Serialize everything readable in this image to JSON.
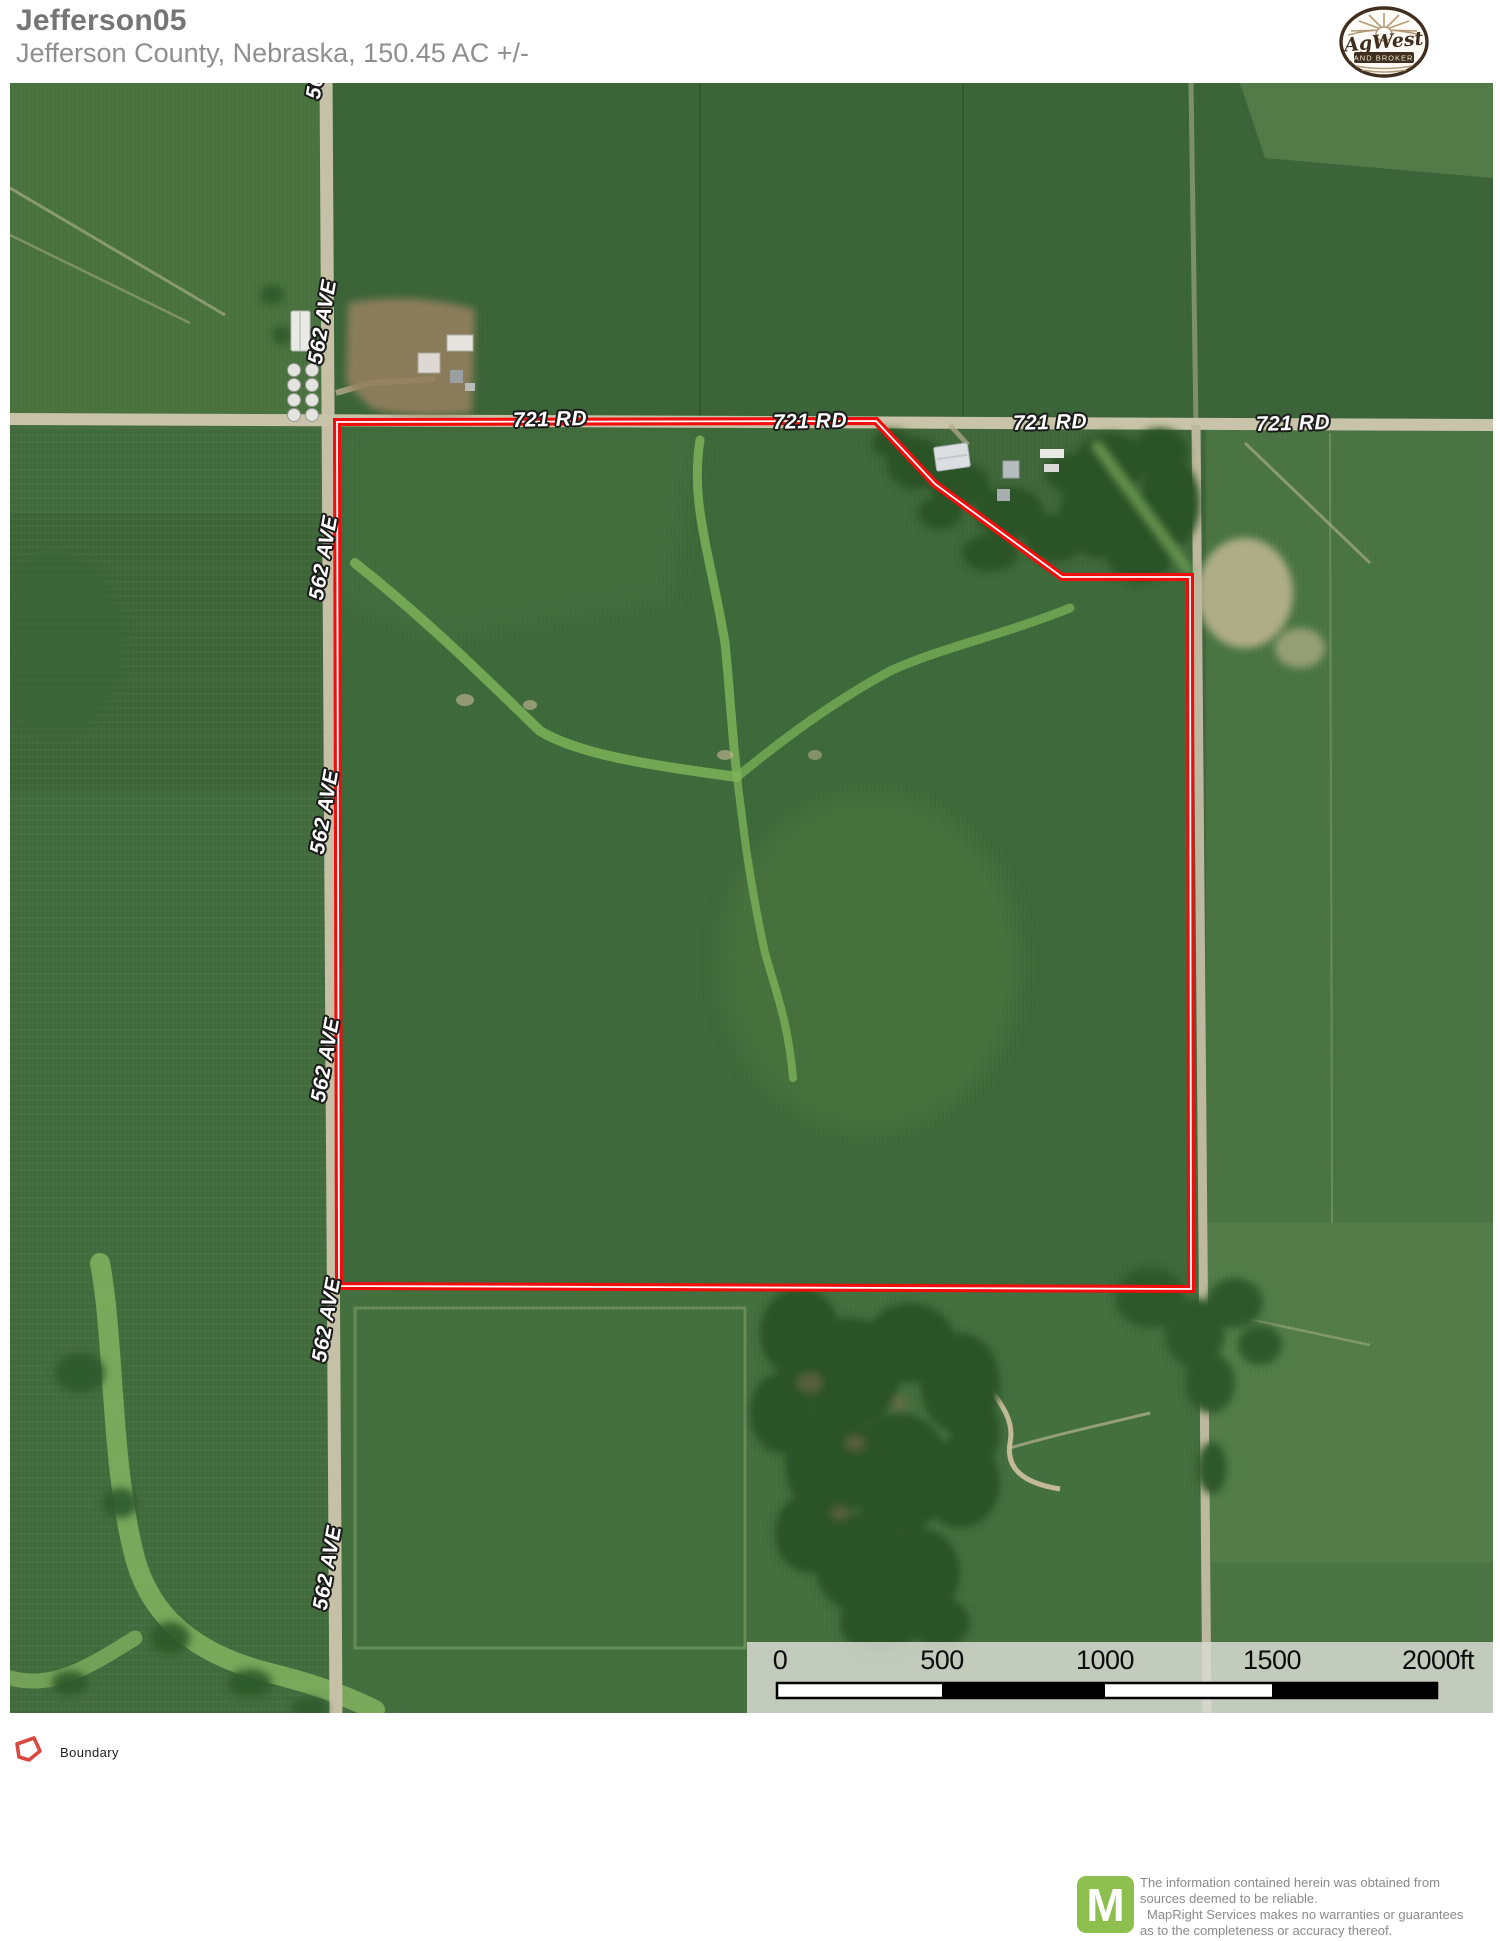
{
  "header": {
    "title": "Jefferson05",
    "subtitle": "Jefferson County, Nebraska, 150.45 AC +/-",
    "logo": {
      "script_text": "AgWest",
      "banner_text": "LAND BROKERS"
    }
  },
  "map": {
    "road_721_label": "721 RD",
    "road_562_label": "562 AVE",
    "scale_bar": {
      "t0": "0",
      "t500": "500",
      "t1000": "1000",
      "t1500": "1500",
      "t2000": "2000ft"
    }
  },
  "legend": {
    "boundary_label": "Boundary"
  },
  "footer": {
    "logo_letter": "M",
    "disclaimer_lines": [
      "The information contained herein was obtained from",
      "sources deemed to be reliable.",
      "MapRight Services makes no warranties or guarantees",
      "as to the completeness or accuracy thereof."
    ]
  },
  "colors": {
    "boundary_red": "#f20d0d",
    "legend_red": "#d84840",
    "mapright_green": "#8cbf4d",
    "title_gray": "#757575",
    "subtitle_gray": "#8f8f8f",
    "disclaimer_gray": "#8a8a8a",
    "field_green": "#41693c",
    "waterway_green": "#7cb258",
    "road_tan": "#c6c1a6",
    "scale_panel": "#d8dad2"
  }
}
